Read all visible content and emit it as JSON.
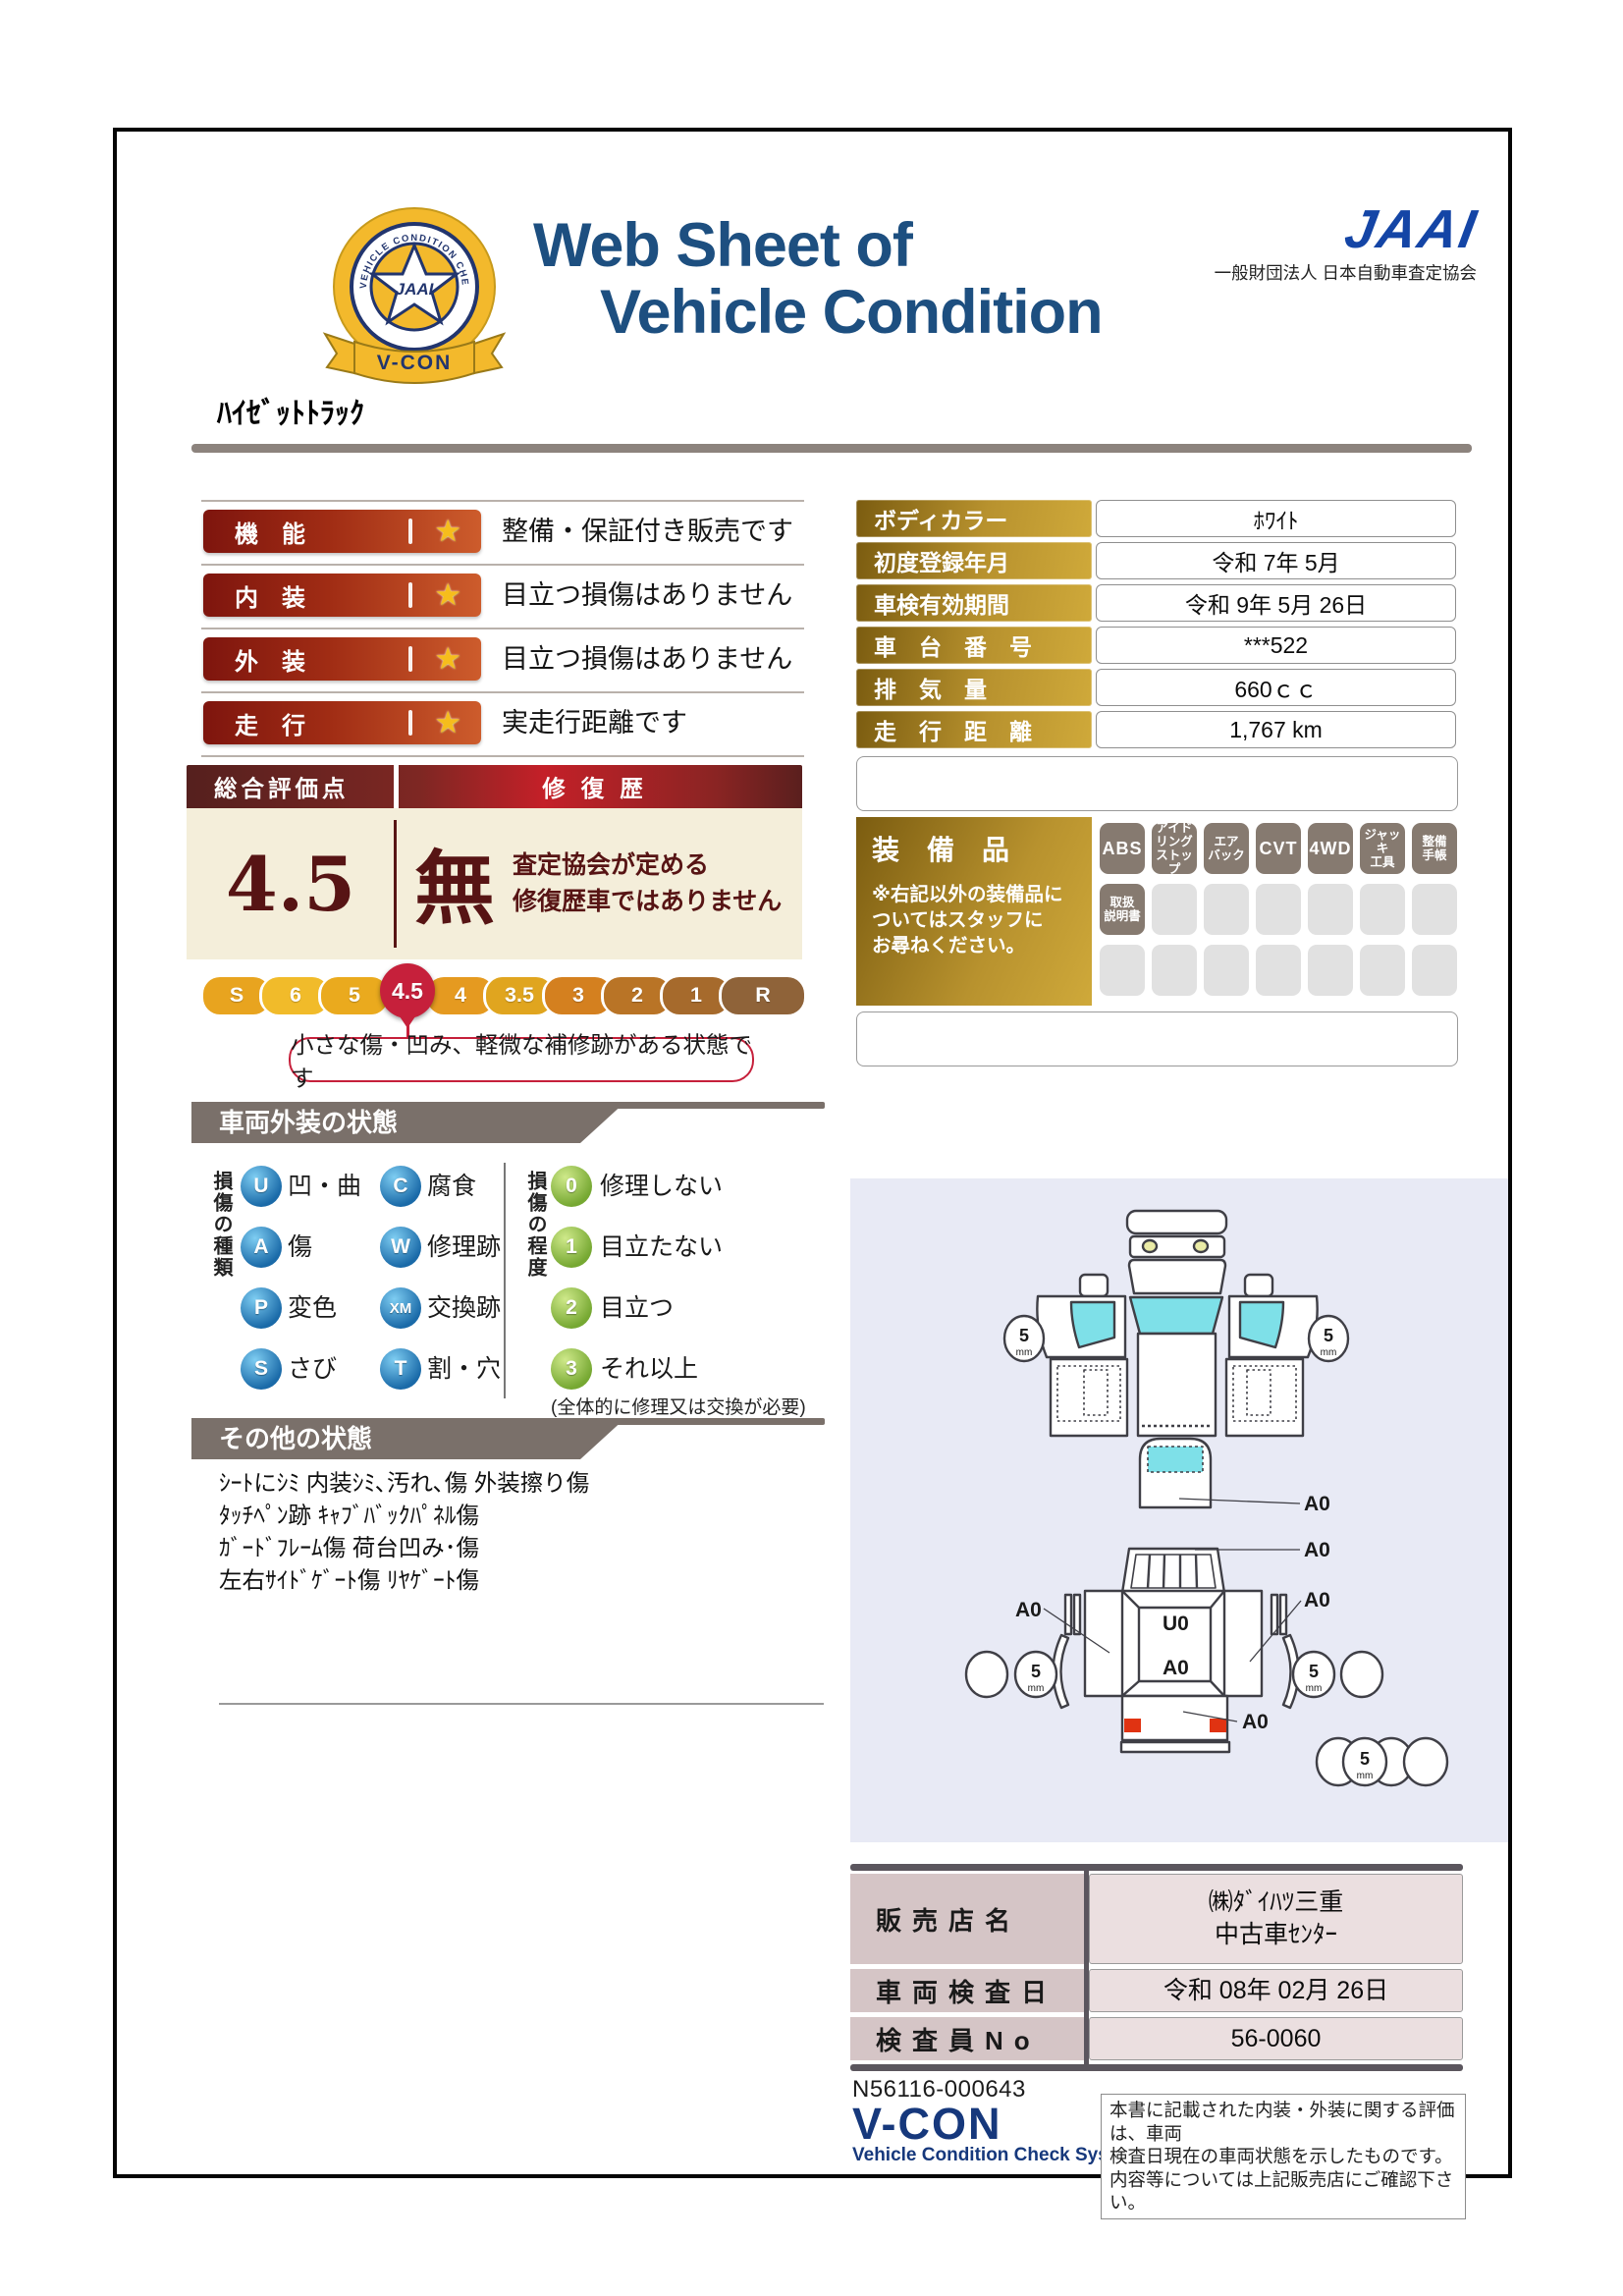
{
  "header": {
    "title_line1": "Web Sheet of",
    "title_line2": "Vehicle Condition",
    "jaai_logo": "JAAI",
    "jaai_org": "一般財団法人 日本自動車査定協会",
    "badge": {
      "ring_text": "VEHICLE CONDITION CHECK SYSTEM",
      "jaai": "JAAI",
      "ribbon": "V-CON"
    }
  },
  "vehicle_name": "ﾊｲｾﾞｯﾄﾄﾗｯｸ",
  "ratings": [
    {
      "label": "機　能",
      "star": "★",
      "desc": "整備・保証付き販売です"
    },
    {
      "label": "内　装",
      "star": "★",
      "desc": "目立つ損傷はありません"
    },
    {
      "label": "外　装",
      "star": "★",
      "desc": "目立つ損傷はありません"
    },
    {
      "label": "走　行",
      "star": "★",
      "desc": "実走行距離です"
    }
  ],
  "overall": {
    "title": "総合評価点",
    "repair_title": "修復歴",
    "score": "4.5",
    "repair_value": "無",
    "repair_note": "査定協会が定める\n修復歴車ではありません",
    "scale": [
      {
        "label": "S"
      },
      {
        "label": "6"
      },
      {
        "label": "5"
      },
      {
        "label": "4.5",
        "selected": true
      },
      {
        "label": "4"
      },
      {
        "label": "3.5"
      },
      {
        "label": "3"
      },
      {
        "label": "2"
      },
      {
        "label": "1"
      },
      {
        "label": "R"
      }
    ],
    "selected_value": "4.5",
    "callout": "小さな傷・凹み、軽微な補修跡がある状態です"
  },
  "info": {
    "rows": [
      {
        "label": "ボディカラー",
        "value": "ﾎﾜｲﾄ"
      },
      {
        "label": "初度登録年月",
        "value": "令和 7年 5月"
      },
      {
        "label": "車検有効期間",
        "value": "令和 9年 5月 26日"
      },
      {
        "label": "車　台　番　号",
        "value": "***522"
      },
      {
        "label": "排　気　量",
        "value": "660ｃｃ"
      },
      {
        "label": "走　行　距　離",
        "value": "1,767 km"
      }
    ]
  },
  "equipment": {
    "title": "装　備　品",
    "note": "※右記以外の装備品に\nついてはスタッフに\nお尋ねください。",
    "tags": [
      "ABS",
      "アイド\nリング\nストップ",
      "エア\nバック",
      "CVT",
      "4WD",
      "ジャッキ\n工具",
      "整備\n手帳",
      "取扱\n説明書"
    ]
  },
  "exterior": {
    "section_title": "車両外装の状態",
    "type_axis": "損傷の種類",
    "types": [
      {
        "code": "U",
        "label": "凹・曲"
      },
      {
        "code": "C",
        "label": "腐食"
      },
      {
        "code": "A",
        "label": "傷"
      },
      {
        "code": "W",
        "label": "修理跡"
      },
      {
        "code": "P",
        "label": "変色"
      },
      {
        "code": "XM",
        "label": "交換跡"
      },
      {
        "code": "S",
        "label": "さび"
      },
      {
        "code": "T",
        "label": "割・穴"
      }
    ],
    "degree_axis": "損傷の程度",
    "degrees": [
      {
        "code": "0",
        "label": "修理しない"
      },
      {
        "code": "1",
        "label": "目立たない"
      },
      {
        "code": "2",
        "label": "目立つ"
      },
      {
        "code": "3",
        "label": "それ以上"
      }
    ],
    "degree_note": "(全体的に修理又は交換が必要)"
  },
  "other": {
    "section_title": "その他の状態",
    "lines": "ｼｰﾄにｼﾐ 内装ｼﾐ､汚れ､傷 外装擦り傷\nﾀｯﾁﾍﾟﾝ跡 ｷｬﾌﾞﾊﾞｯｸﾊﾟﾈﾙ傷\nｶﾞｰﾄﾞﾌﾚｰﾑ傷 荷台凹み･傷\n左右ｻｲﾄﾞｹﾞｰﾄ傷 ﾘﾔｹﾞｰﾄ傷"
  },
  "diagram": {
    "a0": "A0",
    "u0": "U0",
    "tire_depth": "5",
    "tire_unit": "mm"
  },
  "dealer": {
    "rows": [
      {
        "label": "販売店名",
        "value": "㈱ﾀﾞｲﾊﾂ三重\n中古車ｾﾝﾀｰ"
      },
      {
        "label": "車両検査日",
        "value": "令和 08年 02月 26日"
      },
      {
        "label": "検査員No",
        "value": "56-0060"
      }
    ]
  },
  "footer": {
    "doc_no": "N56116-000643",
    "vcon": "V-CON",
    "vcon_sub": "Vehicle Condition Check System",
    "disclaimer": "本書に記載された内装・外装に関する評価は、車両\n検査日現在の車両状態を示したものです。\n内容等については上記販売店にご確認下さい。"
  },
  "colors": {
    "title_navy": "#1d4f80",
    "jaai_blue": "#1445a6",
    "rating_badge_dark": "#7e150e",
    "rating_badge_light": "#cd5c2c",
    "star_gold": "#f6bd1c",
    "maroon_text": "#571414",
    "cream": "#f4eeda",
    "selected_crimson": "#c6203b",
    "scale": [
      "#e8a41f",
      "#f1bb2a",
      "#eaaa1e",
      "#c6203b",
      "#e59a20",
      "#e0a51f",
      "#d4801f",
      "#b97426",
      "#a66a2c",
      "#8f6339"
    ],
    "gold_dark": "#7b5c10",
    "gold_light": "#cfa93a",
    "equip_active": "#867a70",
    "equip_inactive": "#e1e1e1",
    "section_gray": "#7a706a",
    "type_blue": "#1a6aa8",
    "degree_green": "#76a832",
    "diagram_bg": "#e8eaf5",
    "glass_cyan": "#7ee0e8",
    "taillight_red": "#e03312",
    "dealer_label": "#d5c5c6",
    "dealer_value": "#ebdfe0",
    "vcon_navy": "#16387c"
  }
}
